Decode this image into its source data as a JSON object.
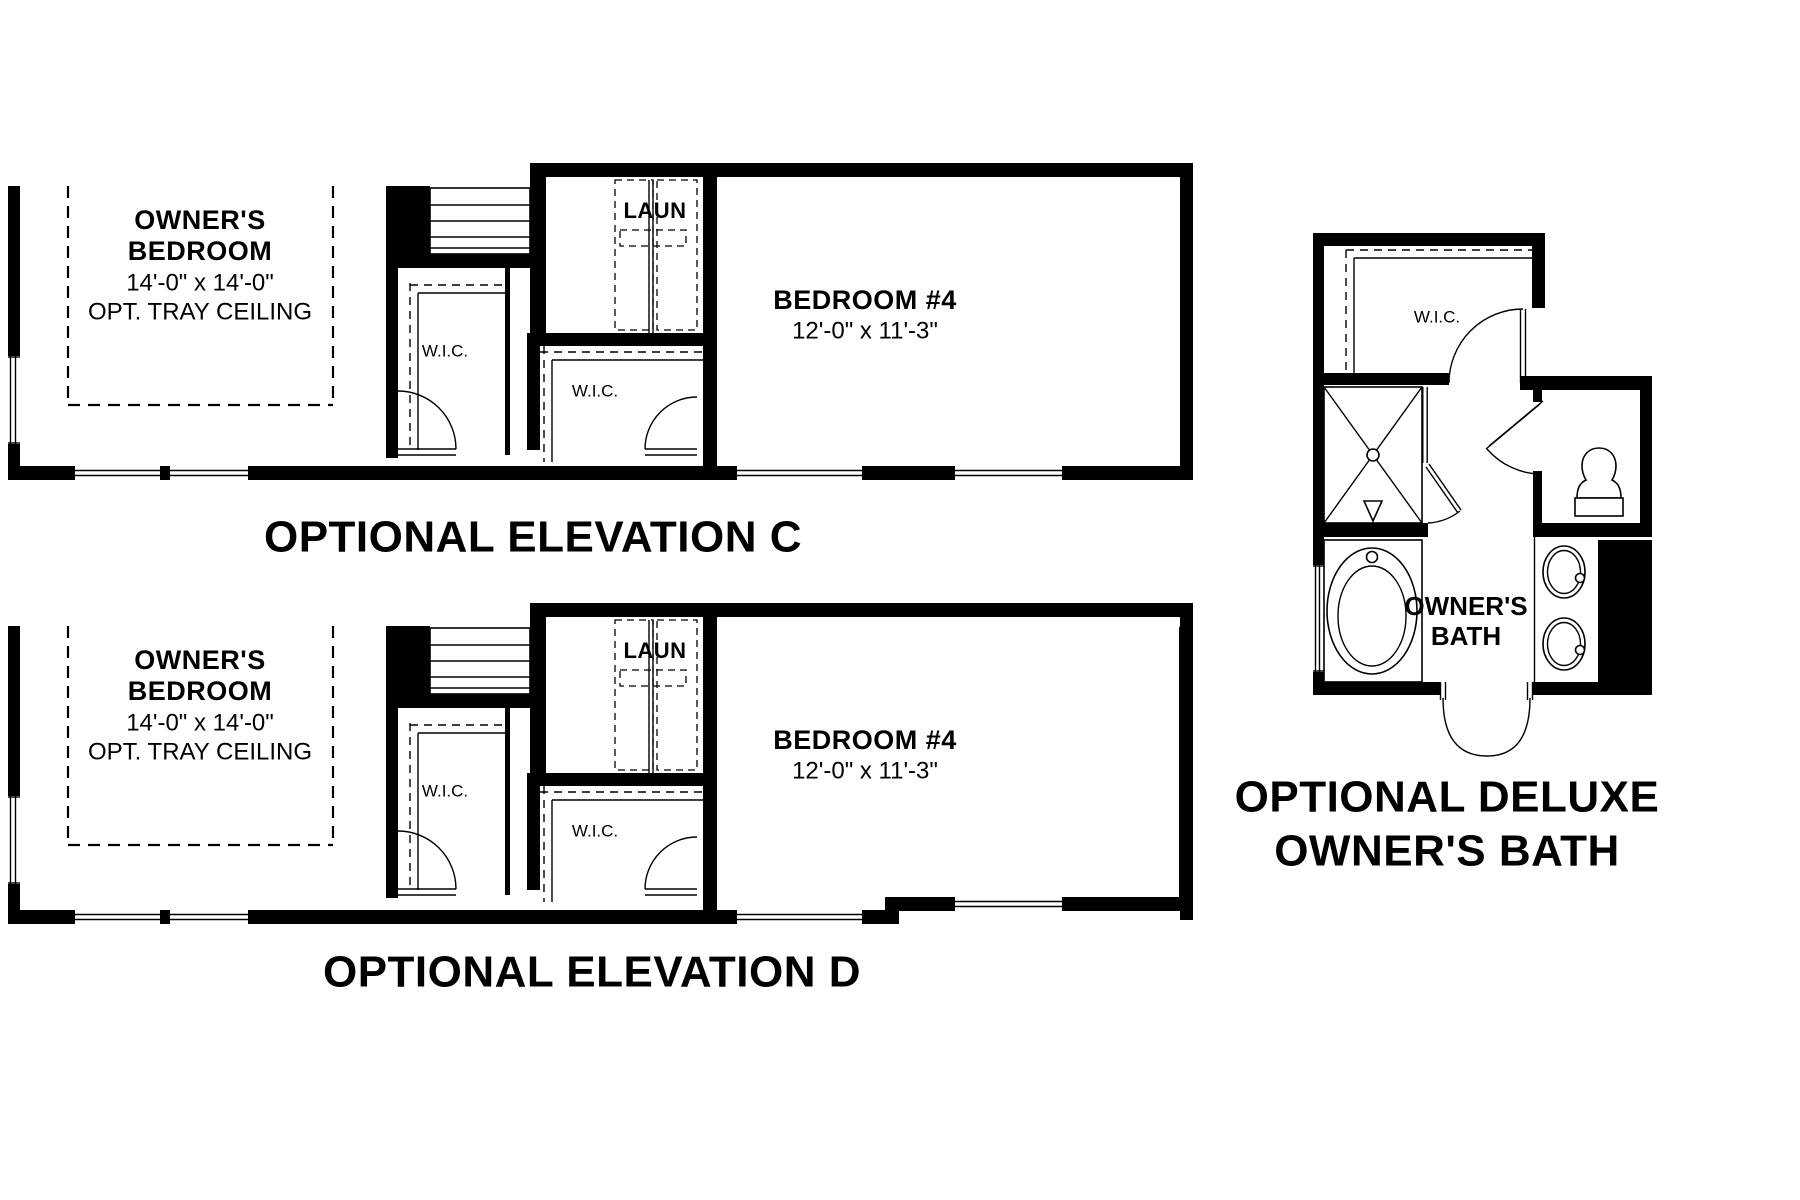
{
  "sheet": {
    "background": "#ffffff",
    "ink": "#000000"
  },
  "plans": {
    "elevation_c": {
      "title": "OPTIONAL ELEVATION C",
      "owners_bedroom_line1": "OWNER'S",
      "owners_bedroom_line2": "BEDROOM",
      "owners_bedroom_dims": "14'-0\" x 14'-0\"",
      "owners_bedroom_note": "OPT. TRAY CEILING",
      "laundry_label": "LAUN",
      "wic_label_1": "W.I.C.",
      "wic_label_2": "W.I.C.",
      "bedroom4_name": "BEDROOM #4",
      "bedroom4_dims": "12'-0\" x 11'-3\""
    },
    "elevation_d": {
      "title": "OPTIONAL ELEVATION D",
      "owners_bedroom_line1": "OWNER'S",
      "owners_bedroom_line2": "BEDROOM",
      "owners_bedroom_dims": "14'-0\" x 14'-0\"",
      "owners_bedroom_note": "OPT. TRAY CEILING",
      "laundry_label": "LAUN",
      "wic_label_1": "W.I.C.",
      "wic_label_2": "W.I.C.",
      "bedroom4_name": "BEDROOM #4",
      "bedroom4_dims": "12'-0\" x 11'-3\""
    },
    "deluxe_bath": {
      "title_line1": "OPTIONAL DELUXE",
      "title_line2": "OWNER'S BATH",
      "wic_label": "W.I.C.",
      "room_line1": "OWNER'S",
      "room_line2": "BATH"
    }
  }
}
